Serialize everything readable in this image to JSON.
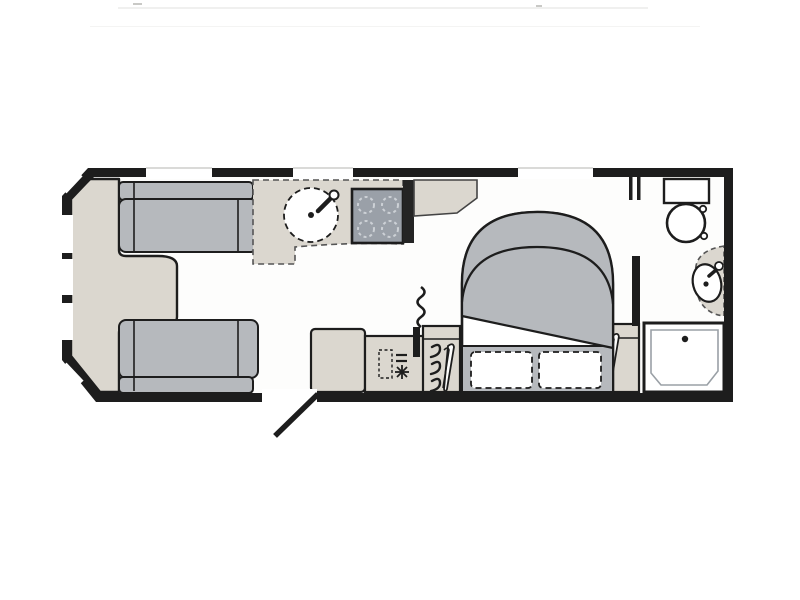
{
  "document": {
    "kind": "caravan-floorplan-drawing",
    "visible_text": [],
    "orientation": "side-on, entry door at bottom centre, lounge left, washroom right"
  },
  "colors": {
    "paper": "#ffffff",
    "floor": "#fdfdfc",
    "wall": "#1d1d1d",
    "upholstery": "#b6b9bd",
    "worktop": "#dbd7cf",
    "hob": "#9aa0a8",
    "line": "#1d1d1d",
    "lightline": "#9aa0a6",
    "window": "#ffffff"
  },
  "zones": {
    "lounge": {
      "fixtures": [
        "front-chest",
        "front-sofa-top",
        "front-sofa-bottom"
      ],
      "windows": [
        "front-diagonal-top",
        "front-left-1",
        "front-left-2",
        "front-left-3",
        "front-diagonal-bottom",
        "top-wall-lounge"
      ]
    },
    "kitchen": {
      "fixtures": [
        "worktop",
        "sink",
        "tap",
        "hob",
        "tall-unit",
        "base-cabinet",
        "fridge",
        "heater-flue"
      ],
      "windows": [
        "top-wall-kitchen"
      ]
    },
    "entry": {
      "fixtures": [
        "entry-door-opening",
        "entry-door-leaf"
      ]
    },
    "bedroom": {
      "fixtures": [
        "bedside-dresser",
        "island-bed",
        "duvet",
        "pillow-left",
        "pillow-right",
        "wardrobe-front",
        "wardrobe-rear"
      ],
      "windows": [
        "top-wall-bedroom"
      ]
    },
    "washroom": {
      "fixtures": [
        "washroom-doorway",
        "toilet",
        "corner-basin",
        "basin-tap",
        "shower-tray",
        "shower-drain"
      ]
    }
  },
  "icon_legend": {
    "hanger-icon": "coat hangers = wardrobe",
    "snowflake-icon": "fridge / freezer",
    "dashed-circle": "sink bowl / hob burner",
    "squiggle-icon": "heater flue"
  }
}
